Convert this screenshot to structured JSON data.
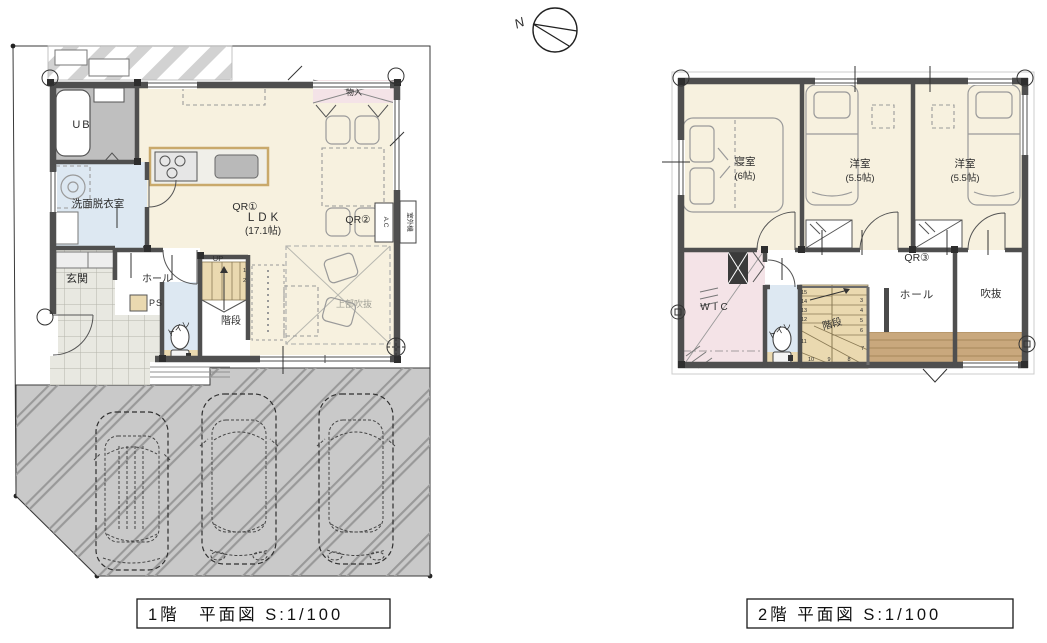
{
  "north_label": "N",
  "captions": {
    "floor1": "1階　平面図 S:1/100",
    "floor2": "2階 平面図 S:1/100"
  },
  "floor1": {
    "labels": {
      "ub": "UB",
      "washroom": "洗面脱衣室",
      "entrance": "玄関",
      "hall": "ホール",
      "ps": "PS",
      "toilet": "トイレ",
      "stairs": "階段",
      "up": "UP",
      "qr1": "QR①",
      "ldk": "LDK",
      "ldk_size": "(17.1帖)",
      "qr2": "QR②",
      "storage": "物入",
      "void_above": "上部吹抜",
      "ac": "A.C",
      "outdoor_unit": "室外機"
    },
    "stair_numbers": [
      "1",
      "2"
    ]
  },
  "floor2": {
    "labels": {
      "bedroom": "寝室",
      "bedroom_size": "(6帖)",
      "western1": "洋室",
      "western1_size": "(5.5帖)",
      "western2": "洋室",
      "western2_size": "(5.5帖)",
      "qr3": "QR③",
      "wic": "WIC",
      "toilet": "トイレ",
      "stairs": "階段",
      "hall": "ホール",
      "void": "吹抜"
    },
    "stair_numbers": [
      "3",
      "4",
      "5",
      "6",
      "7",
      "8",
      "9",
      "10",
      "11",
      "12",
      "13",
      "14",
      "15"
    ]
  },
  "colors": {
    "wall": "#4f4f4f",
    "room_cream": "#f7f1df",
    "room_blue": "#dde8f2",
    "room_pink": "#f4e3e7",
    "ub_gray": "#bfbfbf",
    "tile": "#e8e8e1",
    "paving": "#c9c9c9",
    "wood": "#ead9b0",
    "deck": "#c9a87d"
  }
}
